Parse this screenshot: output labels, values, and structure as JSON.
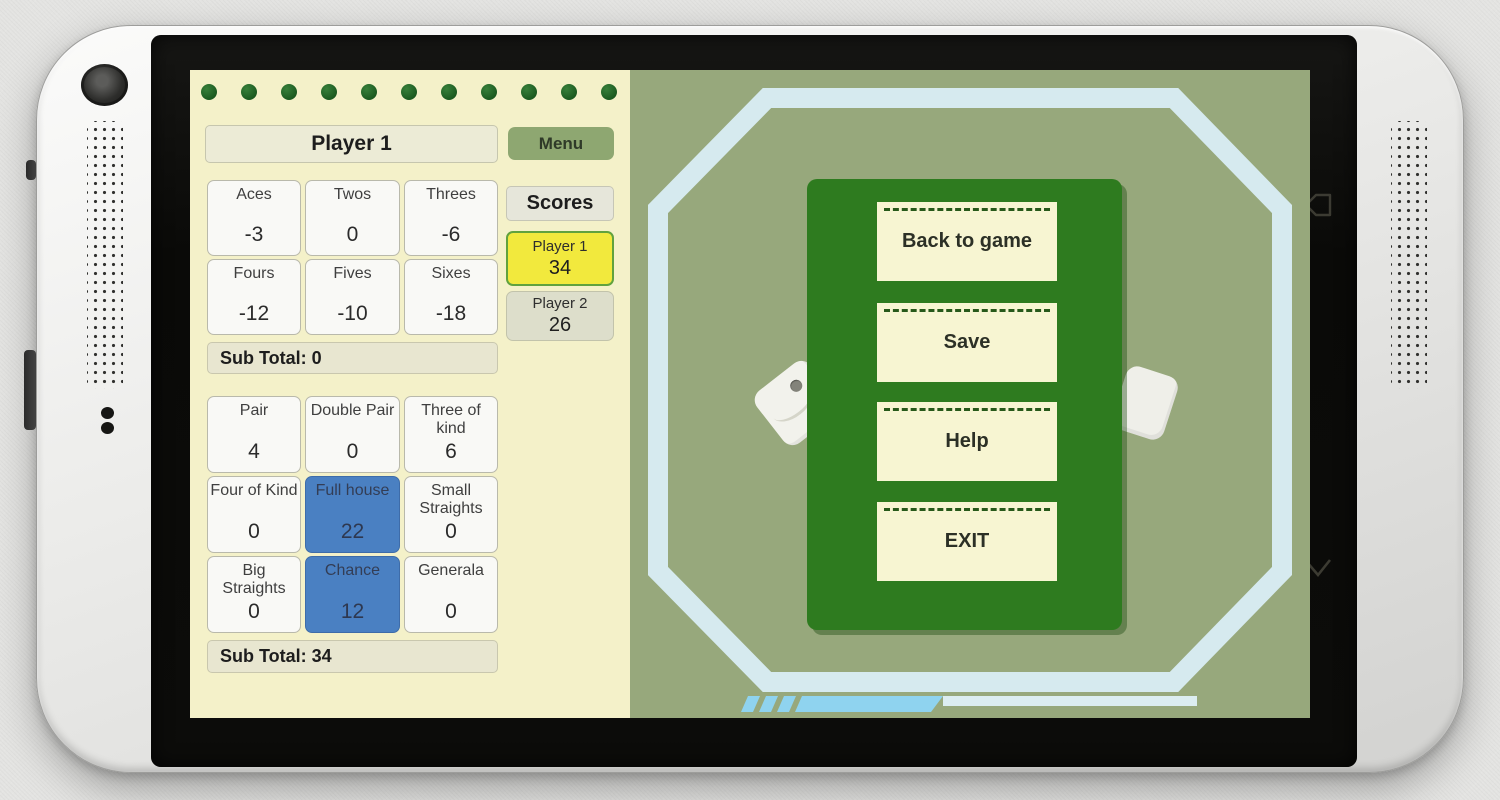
{
  "decor": {
    "dot_count": 11
  },
  "scorecard": {
    "player_header": "Player 1",
    "menu_label": "Menu",
    "upper_cells": [
      {
        "label": "Aces",
        "value": "-3"
      },
      {
        "label": "Twos",
        "value": "0"
      },
      {
        "label": "Threes",
        "value": "-6"
      },
      {
        "label": "Fours",
        "value": "-12"
      },
      {
        "label": "Fives",
        "value": "-10"
      },
      {
        "label": "Sixes",
        "value": "-18"
      }
    ],
    "subtotal_upper": "Sub Total: 0",
    "lower_cells": [
      {
        "label": "Pair",
        "value": "4"
      },
      {
        "label": "Double Pair",
        "value": "0"
      },
      {
        "label": "Three of kind",
        "value": "6"
      },
      {
        "label": "Four of Kind",
        "value": "0"
      },
      {
        "label": "Full house",
        "value": "22",
        "selected": true
      },
      {
        "label": "Small Straights",
        "value": "0"
      },
      {
        "label": "Big Straights",
        "value": "0"
      },
      {
        "label": "Chance",
        "value": "12",
        "selected": true
      },
      {
        "label": "Generala",
        "value": "0"
      }
    ],
    "subtotal_lower": "Sub Total: 34",
    "scores": {
      "title": "Scores",
      "entries": [
        {
          "name": "Player 1",
          "value": "34",
          "active": true
        },
        {
          "name": "Player 2",
          "value": "26",
          "active": false
        }
      ]
    }
  },
  "pause_menu": {
    "buttons": [
      {
        "label": "Back to game"
      },
      {
        "label": "Save"
      },
      {
        "label": "Help"
      },
      {
        "label": "EXIT"
      }
    ]
  },
  "device": {
    "nav_icons": [
      "back-arrow",
      "chevron-down"
    ]
  },
  "colors": {
    "paper_cream": "#f4f1c9",
    "table_olive": "#97a87c",
    "panel_green": "#2e7b1f",
    "selected_cell_blue": "#4a80c2",
    "active_score_yellow": "#f2e93d",
    "active_score_border": "#61a23e",
    "ring_light_blue": "#d6eaef",
    "decor_blue": "#8fd3ef",
    "menu_button_green": "#8ea771"
  }
}
